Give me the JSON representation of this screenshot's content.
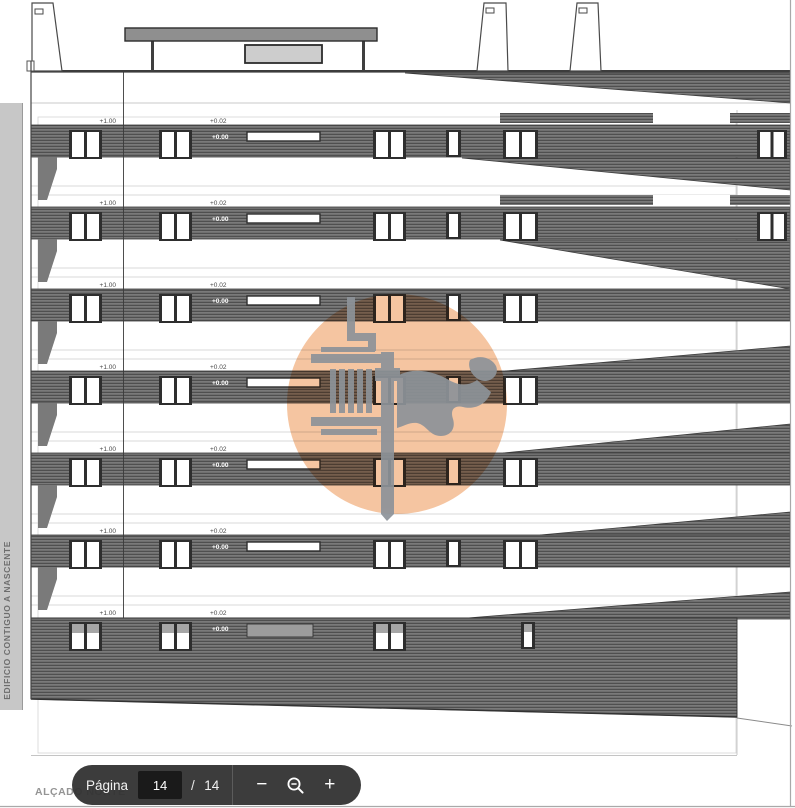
{
  "viewer": {
    "toolbar": {
      "page_label": "Página",
      "current_page": "14",
      "separator": "/",
      "total_pages": "14",
      "zoom_out_label": "−",
      "zoom_in_label": "+",
      "background": "#323232"
    },
    "page_border_color": "#a9a9a9"
  },
  "drawing": {
    "title": "ALÇADO NORTE",
    "side_label": "EDIFICIO CONTIGUO A NASCENTE",
    "floors": [
      {
        "left": "+1.00",
        "upper": "+0.02",
        "lower": "+0.00"
      },
      {
        "left": "+1.00",
        "upper": "+0.02",
        "lower": "+0.00"
      },
      {
        "left": "+1.00",
        "upper": "+0.02",
        "lower": "+0.00"
      },
      {
        "left": "+1.00",
        "upper": "+0.02",
        "lower": "+0.00"
      },
      {
        "left": "+1.00",
        "upper": "+0.02",
        "lower": "+0.00"
      },
      {
        "left": "+1.00",
        "upper": "+0.02",
        "lower": "+0.00"
      },
      {
        "left": "+1.00",
        "upper": "+0.02",
        "lower": "+0.00"
      }
    ],
    "colors": {
      "band": "#6f6f6f",
      "hatch_line": "#4f4f4f",
      "window_frame": "#2e2e2e",
      "faint_line": "#cdcdcd"
    }
  },
  "watermark": {
    "circle_color": "#f4bf97",
    "logo_color": "#8d9399"
  }
}
